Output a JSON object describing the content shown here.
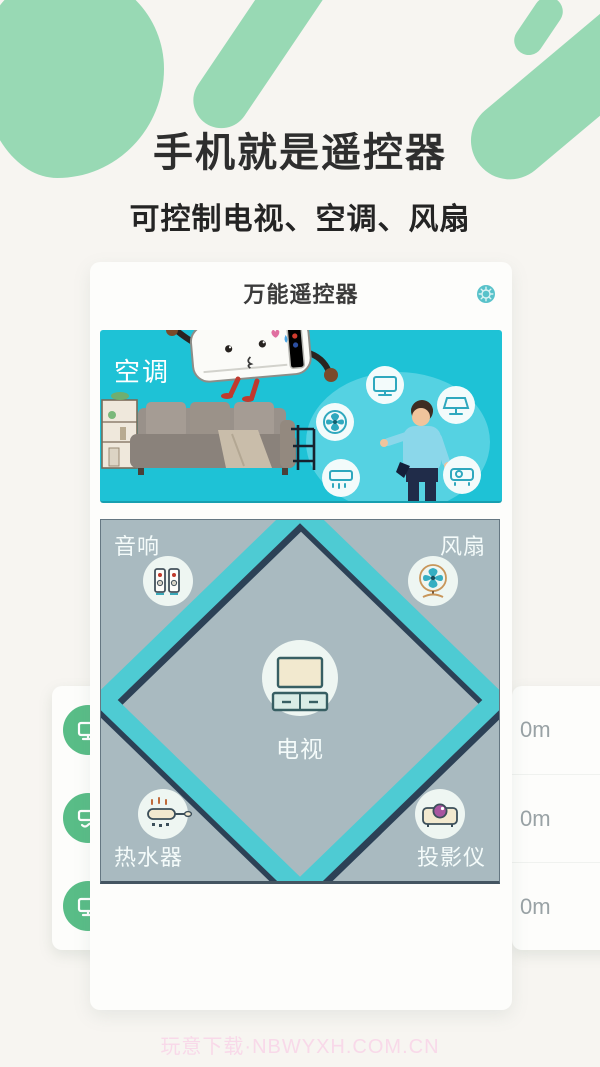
{
  "hero": {
    "title": "手机就是遥控器",
    "subtitle": "可控制电视、空调、风扇"
  },
  "app": {
    "header": {
      "title": "万能遥控器",
      "settings_icon": "gear-icon",
      "accent_color": "#58c2ca"
    },
    "banner": {
      "device_label": "空调",
      "background_color": "#1ec2d6",
      "illustration_icons": [
        "tv-icon",
        "screen-icon",
        "fan-icon",
        "ac-icon",
        "projector-icon"
      ]
    },
    "room_grid": {
      "background_color": "#a9bac0",
      "diamond_color": "#4ecbd3",
      "center": {
        "label": "电视",
        "icon": "tv-icon"
      },
      "corners": [
        {
          "position": "top-left",
          "label": "音响",
          "icon": "speakers-icon"
        },
        {
          "position": "top-right",
          "label": "风扇",
          "icon": "fan-icon"
        },
        {
          "position": "bottom-left",
          "label": "热水器",
          "icon": "water-heater-icon"
        },
        {
          "position": "bottom-right",
          "label": "投影仪",
          "icon": "projector-icon"
        }
      ]
    }
  },
  "left_card": {
    "icon_color": "#59bd87",
    "icons": [
      "tv-icon",
      "ac-icon",
      "tv-icon"
    ]
  },
  "right_card": {
    "distances": [
      "0m",
      "0m",
      "0m"
    ]
  },
  "watermark": "玩意下载·NBWYXH.COM.CN",
  "colors": {
    "page_background": "#f7f5f1",
    "accent_green": "#98d9b4",
    "banner_cyan": "#1ec2d6",
    "diamond_teal": "#4ecbd3",
    "grid_gray": "#a9bac0",
    "circle_green": "#59bd87",
    "distance_gray": "#99a2a5",
    "watermark_pink": "#f8d9e9"
  }
}
